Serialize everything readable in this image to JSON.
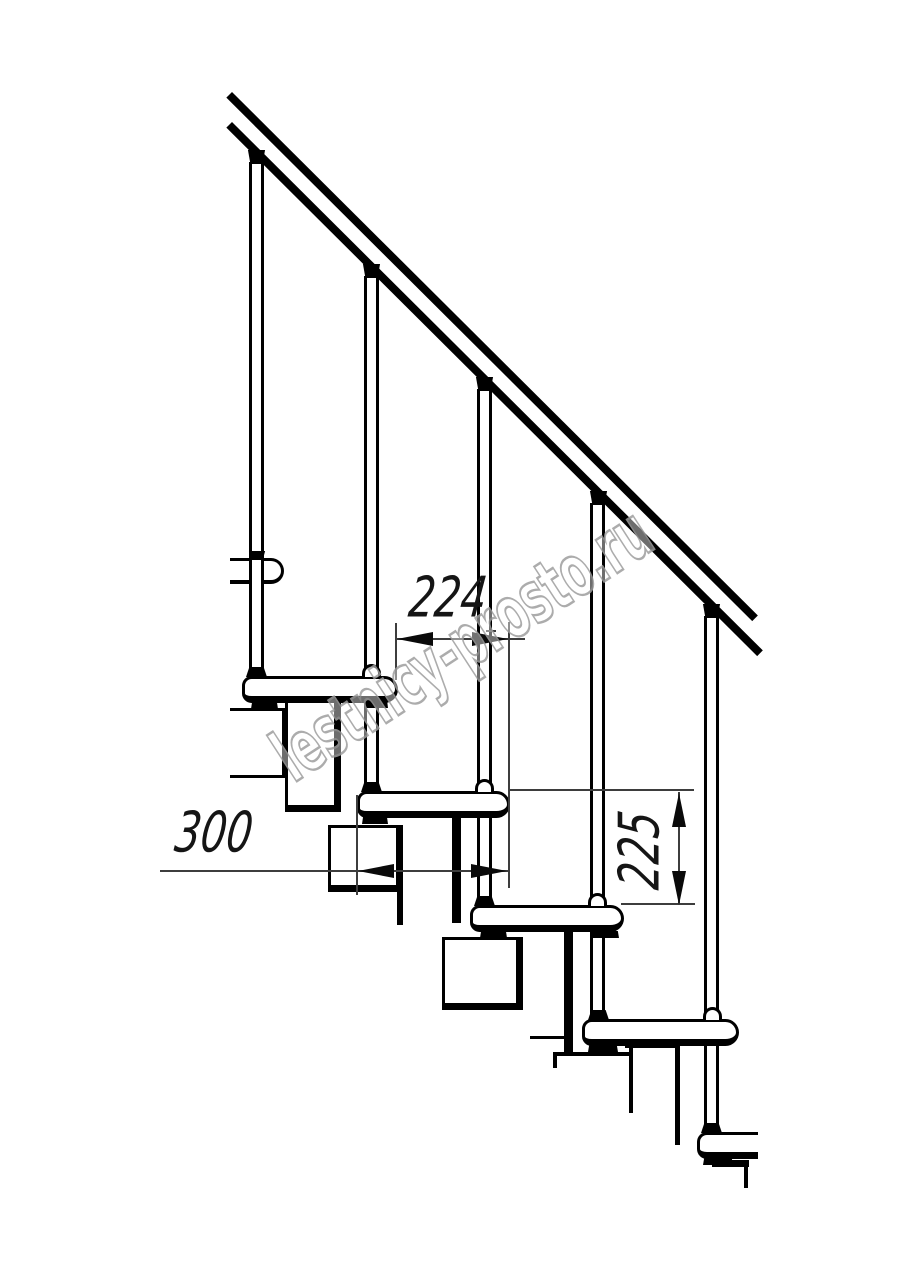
{
  "drawing": {
    "type": "modular staircase side-view technical drawing",
    "watermark_text": "lestnicy-prosto.ru",
    "dimensions": {
      "step_run_mm": "224",
      "tread_depth_mm": "300",
      "riser_height_mm": "225"
    },
    "colors": {
      "line": "#000000",
      "background": "#ffffff",
      "dimension_line": "#3d3d3d",
      "watermark_outline": "#9e9e9e"
    }
  }
}
